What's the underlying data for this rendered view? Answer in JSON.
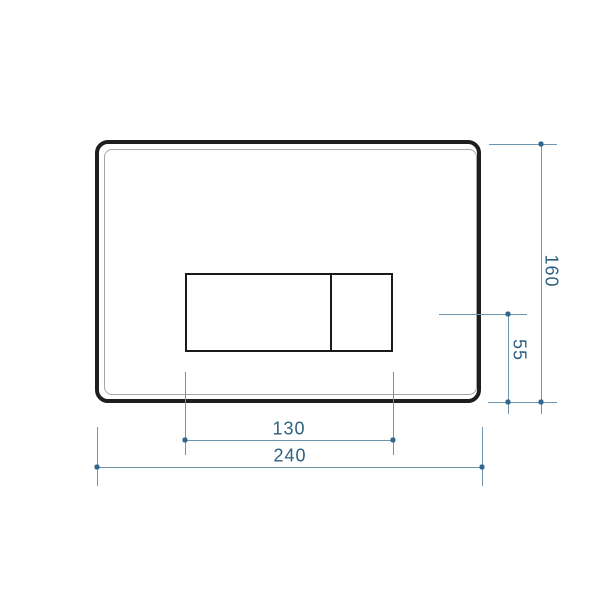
{
  "drawing": {
    "subject": "flush-plate-front-view-dimension-drawing",
    "dimensions": {
      "plate_width": {
        "value": "240"
      },
      "plate_height": {
        "value": "160"
      },
      "button_width": {
        "value": "130"
      },
      "button_center_to_bottom": {
        "value": "55"
      }
    },
    "colors": {
      "plate_outline": "#1e1e1e",
      "inner_outline": "#a5a5a5",
      "dimension_line": "#6e95ad",
      "dimension_tick": "#31678c",
      "dimension_text": "#2d6080",
      "background": "#ffffff"
    }
  }
}
